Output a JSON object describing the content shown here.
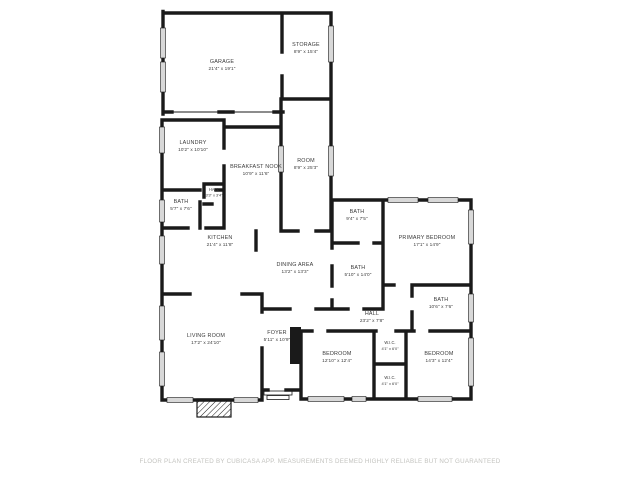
{
  "page": {
    "background": "#ffffff"
  },
  "floor_plan": {
    "wall_color": "#1a1a1a",
    "window_color": "#d8d8d8",
    "label_color": "#3a3a3a",
    "rooms": [
      {
        "name": "GARAGE",
        "dims": "21'4\" x 19'1\""
      },
      {
        "name": "STORAGE",
        "dims": "8'9\" x 15'4\""
      },
      {
        "name": "LAUNDRY",
        "dims": "10'2\" x 10'10\""
      },
      {
        "name": "BREAKFAST NOOK",
        "dims": "10'9\" x 11'6\""
      },
      {
        "name": "ROOM",
        "dims": "8'9\" x 25'3\""
      },
      {
        "name": "HALL",
        "dims": "3'3\" x 3'4\""
      },
      {
        "name": "BATH",
        "dims": "5'7\" x 7'6\""
      },
      {
        "name": "KITCHEN",
        "dims": "21'4\" x 11'8\""
      },
      {
        "name": "DINING AREA",
        "dims": "13'2\" x 13'3\""
      },
      {
        "name": "BATH",
        "dims": "9'4\" x 7'5\""
      },
      {
        "name": "PRIMARY BEDROOM",
        "dims": "17'1\" x 14'9\""
      },
      {
        "name": "BATH",
        "dims": "5'10\" x 14'0\""
      },
      {
        "name": "BATH",
        "dims": "10'6\" x 7'6\""
      },
      {
        "name": "HALL",
        "dims": "23'2\" x 7'8\""
      },
      {
        "name": "FOYER",
        "dims": "5'11\" x 10'9\""
      },
      {
        "name": "LIVING ROOM",
        "dims": "17'2\" x 24'10\""
      },
      {
        "name": "BEDROOM",
        "dims": "12'10\" x 12'4\""
      },
      {
        "name": "W.I.C.",
        "dims": "4'1\" x 6'0\""
      },
      {
        "name": "W.I.C.",
        "dims": "4'1\" x 6'0\""
      },
      {
        "name": "BEDROOM",
        "dims": "14'3\" x 12'4\""
      }
    ]
  },
  "footer": {
    "text": "FLOOR PLAN CREATED BY CUBICASA APP. MEASUREMENTS DEEMED HIGHLY RELIABLE BUT NOT GUARANTEED"
  }
}
